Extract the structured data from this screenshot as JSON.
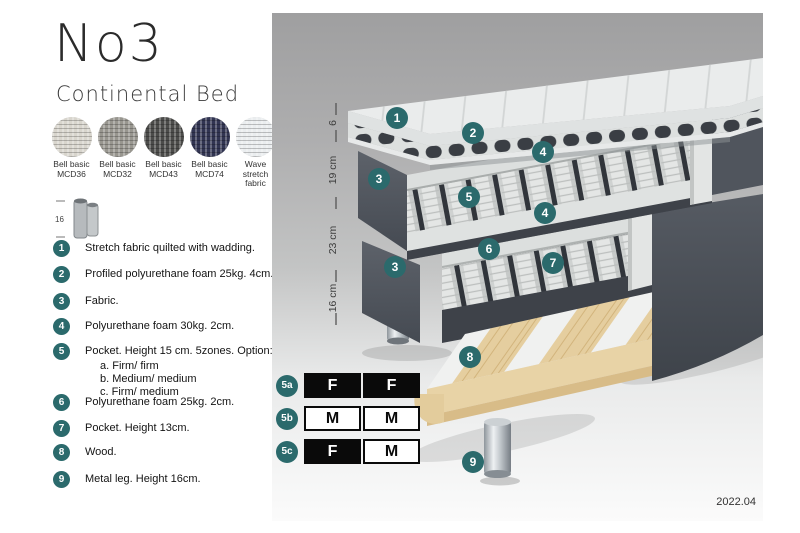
{
  "header": {
    "title": "No3",
    "subtitle": "Continental Bed"
  },
  "swatches": [
    {
      "line1": "Bell basic",
      "line2": "MCD36",
      "color": "#d8d5cd"
    },
    {
      "line1": "Bell basic",
      "line2": "MCD32",
      "color": "#98968f"
    },
    {
      "line1": "Bell basic",
      "line2": "MCD43",
      "color": "#4c4c4a"
    },
    {
      "line1": "Bell basic",
      "line2": "MCD74",
      "color": "#323552"
    },
    {
      "line1": "Wave",
      "line2": "stretch fabric",
      "color": "#eaedef"
    }
  ],
  "leg_icon": {
    "dim": "16"
  },
  "callouts": [
    {
      "num": "1",
      "text": "Stretch fabric quilted with wadding."
    },
    {
      "num": "2",
      "text": "Profiled polyurethane foam 25kg. 4cm."
    },
    {
      "num": "3",
      "text": "Fabric."
    },
    {
      "num": "4",
      "text": "Polyurethane foam 30kg. 2cm."
    },
    {
      "num": "5",
      "text": "Pocket. Height 15 cm. 5zones. Option:",
      "options": [
        "a. Firm/ firm",
        "b. Medium/ medium",
        "c. Firm/ medium"
      ]
    },
    {
      "num": "6",
      "text": "Polyurethane foam 25kg. 2cm."
    },
    {
      "num": "7",
      "text": "Pocket. Height 13cm."
    },
    {
      "num": "8",
      "text": "Wood."
    },
    {
      "num": "9",
      "text": "Metal leg. Height 16cm."
    }
  ],
  "ruler": {
    "labels": [
      "6",
      "19 cm",
      "23 cm",
      "16 cm"
    ]
  },
  "firmness": {
    "rows": [
      {
        "badge": "5a",
        "cells": [
          {
            "letter": "F",
            "variant": "dark"
          },
          {
            "letter": "F",
            "variant": "dark"
          }
        ]
      },
      {
        "badge": "5b",
        "cells": [
          {
            "letter": "M",
            "variant": "light"
          },
          {
            "letter": "M",
            "variant": "light"
          }
        ]
      },
      {
        "badge": "5c",
        "cells": [
          {
            "letter": "F",
            "variant": "dark"
          },
          {
            "letter": "M",
            "variant": "light"
          }
        ]
      }
    ]
  },
  "version": "2022.04",
  "colors": {
    "badge": "#2b6a6c",
    "fabric": "#555a62",
    "wood": "#e5ce9f",
    "table": "#0a0a0a"
  }
}
